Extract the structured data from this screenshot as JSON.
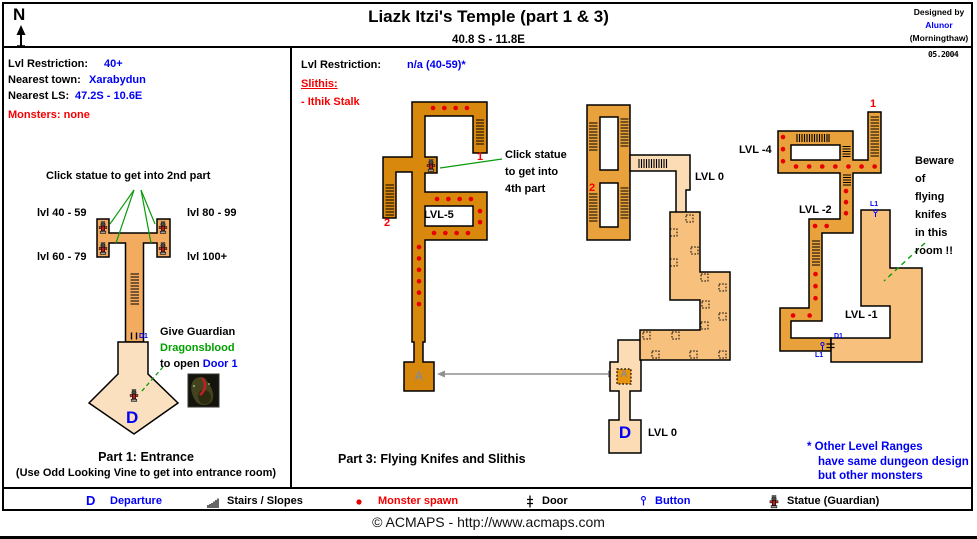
{
  "header": {
    "compass": "N",
    "title": "Liazk Itzi's Temple (part 1 & 3)",
    "coords": "40.8 S - 11.8E",
    "designed_by": "Designed by",
    "designer": "Alunor",
    "world": "(Morningthaw)",
    "date": "05.2004"
  },
  "part1": {
    "info": {
      "lvl_restriction_label": "Lvl Restriction:",
      "lvl_restriction": "40+",
      "nearest_town_label": "Nearest town:",
      "nearest_town": "Xarabydun",
      "nearest_ls_label": "Nearest LS:",
      "nearest_ls": "47.2S - 10.6E",
      "monsters": "Monsters: none"
    },
    "map": {
      "statue_note": "Click statue to get into 2nd part",
      "lvl_40_59": "lvl 40 - 59",
      "lvl_80_99": "lvl 80 - 99",
      "lvl_60_79": "lvl 60 - 79",
      "lvl_100": "lvl 100+",
      "door1_tag": "D1",
      "give_guardian": "Give Guardian",
      "dragonsblood": "Dragonsblood",
      "to_open": "to open",
      "door1_link": "Door 1",
      "departure": "D"
    },
    "caption": "Part 1: Entrance",
    "caption_sub": "(Use Odd Looking Vine to get into entrance room)"
  },
  "part3": {
    "info": {
      "lvl_restriction_label": "Lvl Restriction:",
      "lvl_restriction": "n/a (40-59)*",
      "slithis_label": "Slithis:",
      "slithis_item": "- Ithik Stalk"
    },
    "map": {
      "lvl5": {
        "label": "LVL-5",
        "stairs1": "1",
        "stairs2": "2",
        "portal": "A",
        "note": [
          "Click statue",
          "to get into",
          "4th part"
        ]
      },
      "lvl0": {
        "label_top": "LVL 0",
        "label_bottom": "LVL 0",
        "stairs2": "2",
        "portal": "A",
        "departure": "D"
      },
      "lvl4": {
        "label": "LVL -4",
        "stairs1": "1"
      },
      "lvl2": {
        "label": "LVL -2"
      },
      "lvl1": {
        "label": "LVL -1",
        "button_top": "L1",
        "door": "D1",
        "button_bottom": "L1",
        "warn": [
          "Beware",
          "of",
          "flying",
          "knifes",
          "in this",
          "room !!"
        ]
      }
    },
    "note": {
      "line1": "* Other Level Ranges",
      "line2": "have same dungeon design",
      "line3": "but other monsters"
    },
    "caption": "Part 3: Flying Knifes and Slithis"
  },
  "legend": {
    "departure_symbol": "D",
    "departure": "Departure",
    "stairs": "Stairs / Slopes",
    "monster": "Monster spawn",
    "door": "Door",
    "button": "Button",
    "statue": "Statue (Guardian)"
  },
  "footer": {
    "copyright": "© ACMAPS - http://www.acmaps.com"
  },
  "colors": {
    "accent_blue": "#0000f5",
    "warn_red": "#f50000",
    "monster_red": "#e80000",
    "line_green": "#0a9c0a",
    "dungeon_dark": "#d8880c",
    "dungeon_mid": "#e9a23b",
    "dungeon_light": "#f8c07d",
    "corridor_peach": "#fbdcb4",
    "part1_room": "#f3ac5f",
    "part1_entrance": "#fbe0c0"
  }
}
